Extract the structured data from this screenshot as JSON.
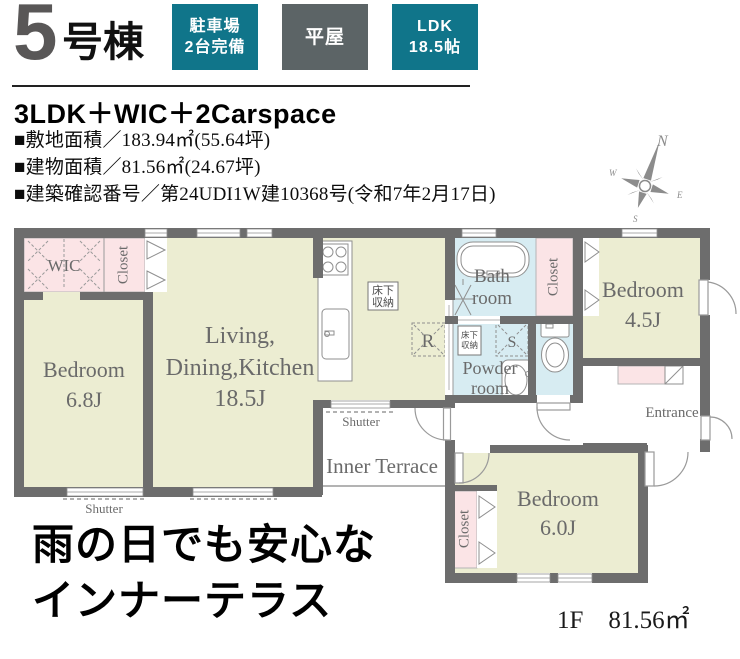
{
  "header": {
    "unit_number": "5",
    "unit_suffix": "号棟",
    "badges": [
      {
        "lines": [
          "駐車場",
          "2台完備"
        ],
        "color": "#10758a"
      },
      {
        "lines": [
          "平屋"
        ],
        "color": "#5c6466"
      },
      {
        "lines": [
          "LDK",
          "18.5帖"
        ],
        "color": "#10758a"
      }
    ],
    "layout_summary": "3LDK＋WIC＋2Carspace"
  },
  "property": {
    "site_area": "■敷地面積／183.94㎡(55.64坪)",
    "building_area": "■建物面積／81.56㎡(24.67坪)",
    "confirmation_number": "■建築確認番号／第24UDI1W建10368号(令和7年2月17日)"
  },
  "compass": {
    "north": "N",
    "south": "S",
    "east": "E",
    "west": "W"
  },
  "plan": {
    "labels": {
      "wic": "WIC",
      "closet": "Closet",
      "bedroom": "Bedroom",
      "bedroom1_size": "6.8J",
      "bedroom2_size": "4.5J",
      "bedroom3_size": "6.0J",
      "ldk1": "Living,",
      "ldk2": "Dining,Kitchen",
      "ldk3": "18.5J",
      "bath1": "Bath",
      "bath2": "room",
      "powder1": "Powder",
      "powder2": "room",
      "entrance": "Entrance",
      "inner_terrace": "Inner Terrace",
      "shutter": "Shutter",
      "floor_storage1": "床下",
      "floor_storage2": "収納",
      "refrigerator_mark": "R",
      "washer_mark": "S"
    },
    "colors": {
      "wall": "#6d6d6d",
      "room": "#ecedd2",
      "closet_pink": "#fbe4e6",
      "wet_blue": "#d7ecf2"
    }
  },
  "footer": {
    "catch1": "雨の日でも安心な",
    "catch2": "インナーテラス",
    "floor_label": "1F　81.56㎡"
  }
}
